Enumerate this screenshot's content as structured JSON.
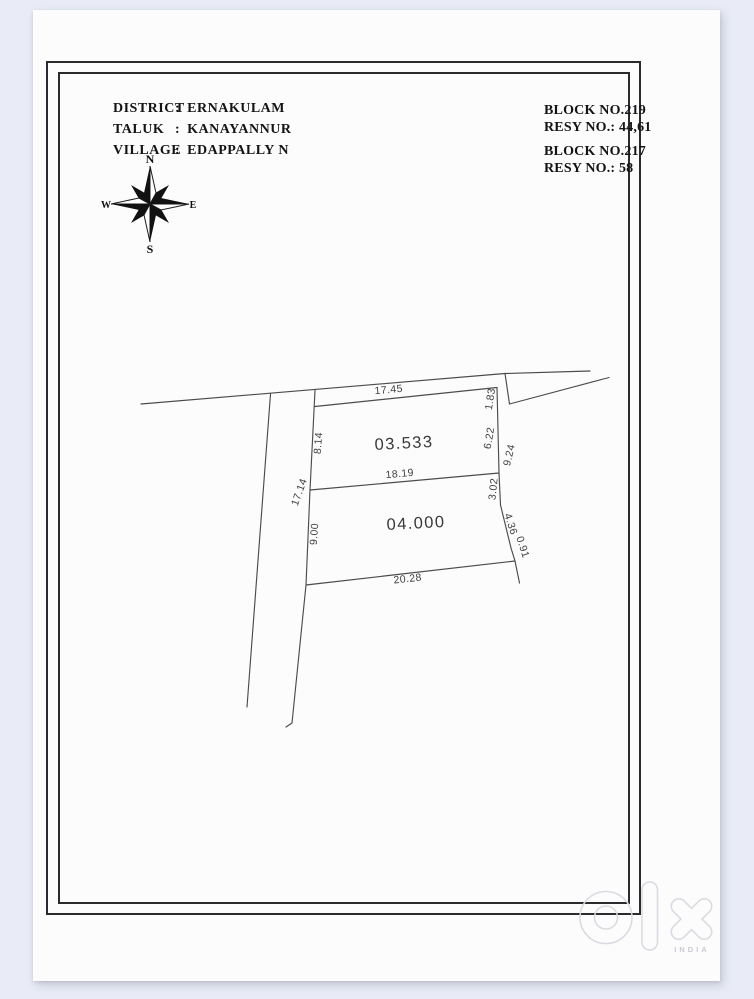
{
  "document": {
    "location": {
      "colon": ":",
      "rows": [
        {
          "label": "DISTRICT",
          "value": "ERNAKULAM"
        },
        {
          "label": "TALUK",
          "value": "KANAYANNUR"
        },
        {
          "label": "VILLAGE",
          "value": "EDAPPALLY N"
        }
      ]
    },
    "survey_refs": [
      {
        "block": "BLOCK NO.219",
        "resy": "RESY NO.: 44,61"
      },
      {
        "block": "BLOCK NO.217",
        "resy": "RESY NO.: 58"
      }
    ],
    "compass": {
      "north": "N",
      "south": "S",
      "east": "E",
      "west": "W"
    },
    "plots": [
      {
        "area_label": "03.533"
      },
      {
        "area_label": "04.000"
      }
    ],
    "dimensions": {
      "top": "17.45",
      "ne_side": "1.83",
      "west_upper": "8.14",
      "east_upper": "6.22",
      "east_total": "9.24",
      "middle": "18.19",
      "west_total": "17.14",
      "east_lower": "3.02",
      "west_lower": "9.00",
      "se_diag": "4.36",
      "se_tail": "0.91",
      "bottom": "20.28"
    },
    "watermark": {
      "brand": "olx",
      "country": "INDIA"
    }
  }
}
